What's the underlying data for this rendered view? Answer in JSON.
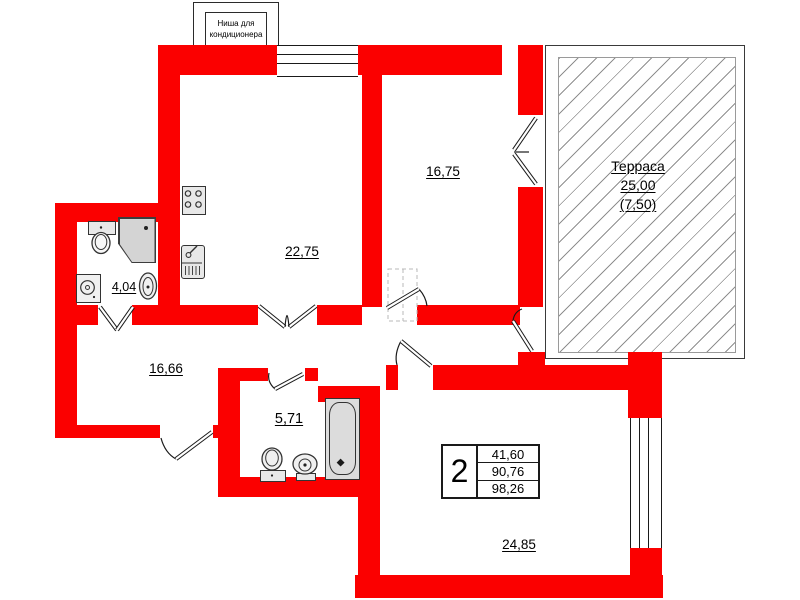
{
  "niche": {
    "line1": "Ниша для",
    "line2": "кондиционера"
  },
  "rooms": {
    "living": "22,75",
    "bedroom_top": "16,75",
    "wc": "4,04",
    "hall": "16,66",
    "bath": "5,71",
    "bedroom_bottom": "24,85"
  },
  "terrace": {
    "name": "Терраса",
    "area": "25,00",
    "reduced_area": "(7,50)"
  },
  "summary": {
    "rooms_count": "2",
    "living_area": "41,60",
    "apartment_area": "90,76",
    "total_area": "98,26"
  },
  "colors": {
    "wall": "#fb0000",
    "hatch_line": "#8f8f8f",
    "outline": "#1a1a1a",
    "fixture_fill": "#e8e8e8"
  }
}
